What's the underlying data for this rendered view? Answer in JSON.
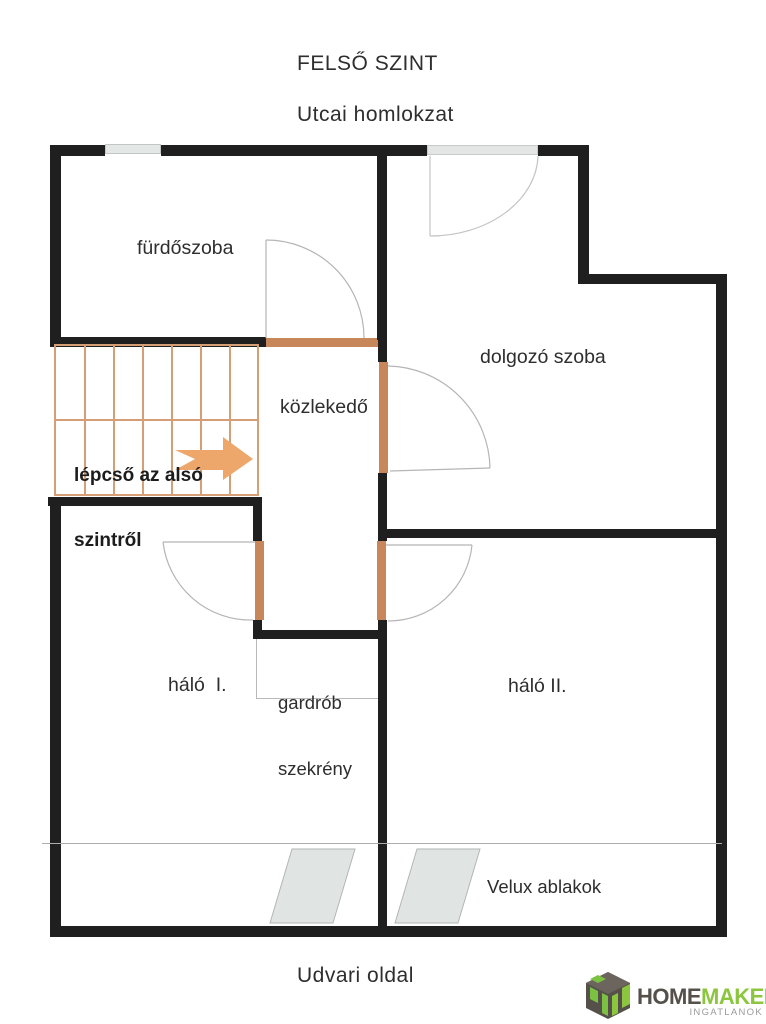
{
  "header": {
    "title": "FELSŐ SZINT",
    "facade_label": "Utcai homlokzat"
  },
  "footer": {
    "side_label": "Udvari oldal"
  },
  "rooms": {
    "bathroom": {
      "label": "fürdőszoba"
    },
    "study": {
      "label": "dolgozó szoba"
    },
    "hallway": {
      "label": "közlekedő"
    },
    "bedroom1": {
      "label": "háló  I."
    },
    "bedroom2": {
      "label": "háló II."
    },
    "wardrobe": {
      "label_line1": "gardrób",
      "label_line2": "szekrény"
    },
    "velux": {
      "label": "Velux ablakok"
    }
  },
  "stairs": {
    "note_line1": "lépcső az alsó",
    "note_line2": "szintről",
    "arrow_direction": "right"
  },
  "logo": {
    "brand_part1": "HOME",
    "brand_part2": "MAKER",
    "tagline": "INGATLANOK"
  },
  "colors": {
    "wall": "#1f1f1f",
    "stair_outline": "#d49f76",
    "door_leaf": "#c8875a",
    "arrow_fill": "#eda76a",
    "swing_line": "#b5b5b5",
    "window_fill": "#e3e7e6",
    "velux_fill": "#e0e4e3",
    "logo_dark": "#56504a",
    "logo_green": "#8cc63e",
    "tagline_gray": "#9b9b9b"
  }
}
